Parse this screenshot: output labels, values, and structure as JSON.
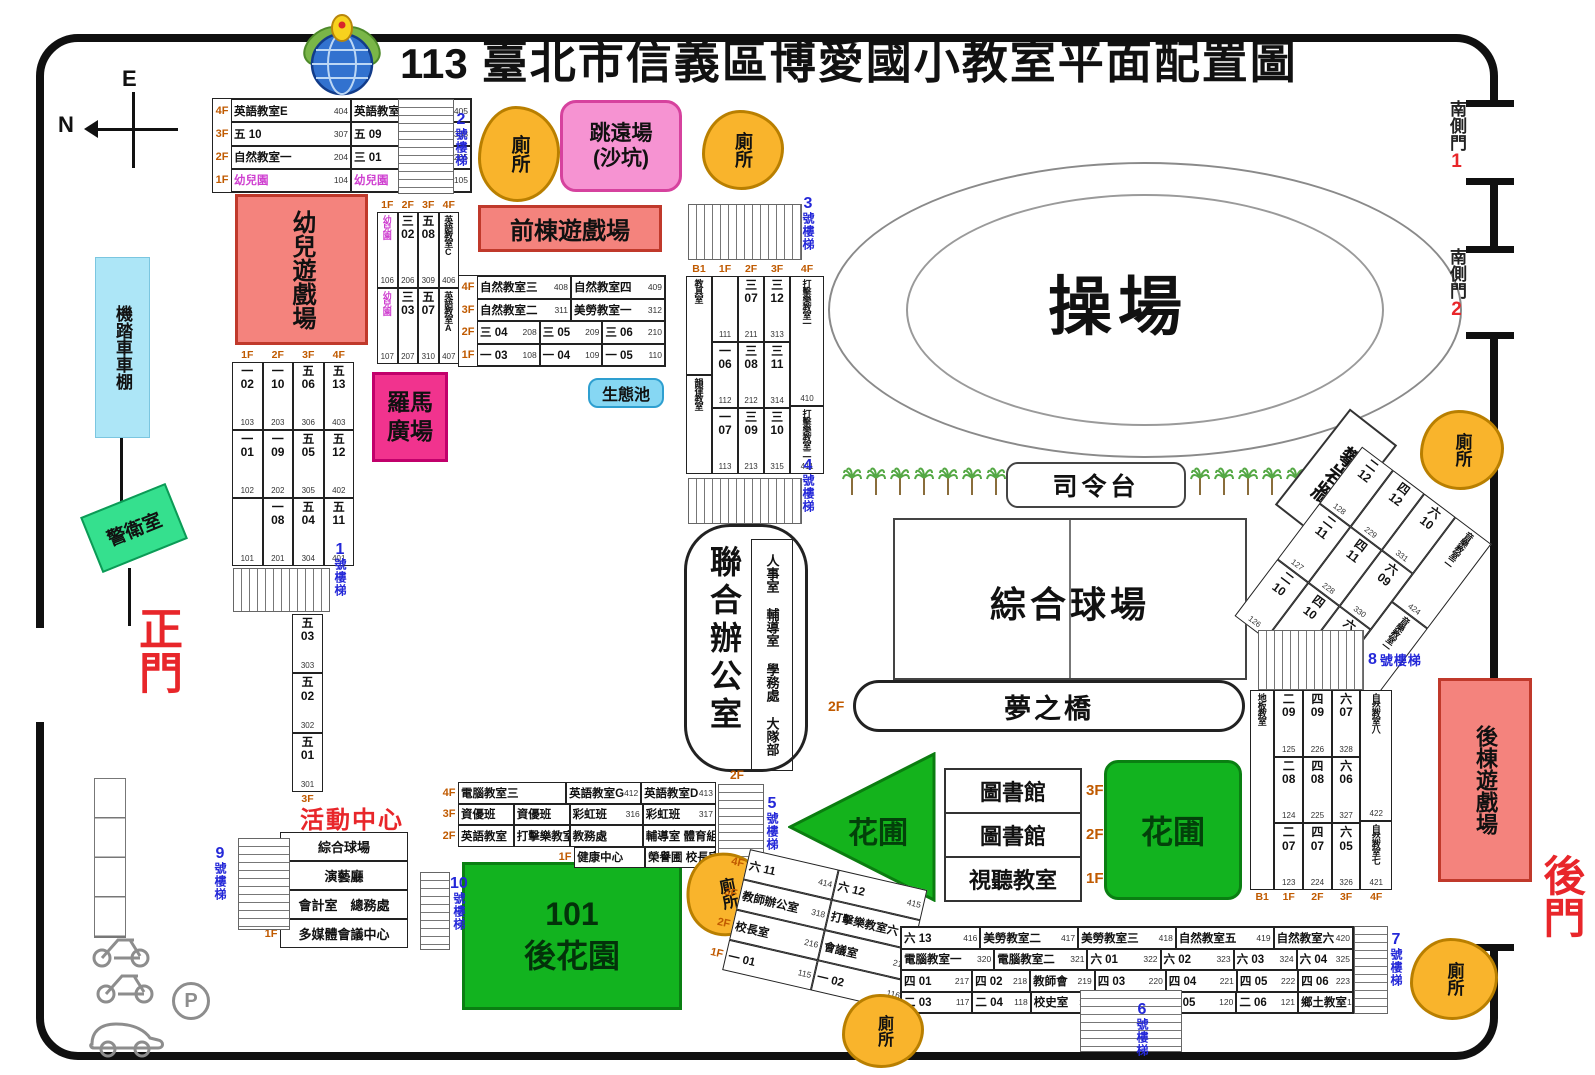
{
  "title": {
    "year": "113",
    "text": "臺北市信義區博愛國小教室平面配置圖"
  },
  "compass": {
    "e": "E",
    "n": "N"
  },
  "gates": {
    "main": "正門",
    "back": "後門",
    "south": "南側門",
    "south1_num": "1",
    "south2_num": "2"
  },
  "stairs": {
    "suffix": "號樓梯",
    "s1": {
      "n": "1",
      "t": "號樓梯"
    },
    "s2": {
      "n": "2",
      "t": "號樓梯"
    },
    "s3": {
      "n": "3",
      "t": "號樓梯"
    },
    "s4": {
      "n": "4",
      "t": "號樓梯"
    },
    "s5": {
      "n": "5",
      "t": "號樓梯"
    },
    "s6": {
      "n": "6",
      "t": "號樓梯"
    },
    "s7": {
      "n": "7",
      "t": "號樓梯"
    },
    "s8": {
      "n": "8",
      "t": "號樓梯"
    },
    "s9": {
      "n": "9",
      "t": "號樓梯"
    },
    "s10": {
      "n": "10",
      "t": "號樓梯"
    }
  },
  "zones": {
    "kinder_play": "幼兒遊戲場",
    "front_play": "前棟遊戲場",
    "back_play": "後棟遊戲場",
    "long_jump": [
      "跳遠場",
      "(沙坑)"
    ],
    "roman_plaza": [
      "羅馬",
      "廣場"
    ],
    "eco_pond": "生態池",
    "bike_shed": "機踏車車棚",
    "guard": "警衛室",
    "toilet": "廁所",
    "track": "操場",
    "stage": "司令台",
    "court": "綜合球場",
    "dream_bridge": "夢之橋",
    "dream_bridge_floor": "2F",
    "flower_tri": "花圃",
    "flower_sq": "花圃",
    "back_garden": [
      "101",
      "後花園"
    ],
    "climb_wall": "攀岩牆",
    "parking_p": "P",
    "strip_3f": "3F"
  },
  "joint_office": {
    "title": "聯合辦公室",
    "rooms": [
      "人事室",
      "輔導室",
      "學務處",
      "大隊部"
    ],
    "floor": "2F"
  },
  "library": {
    "rows": [
      {
        "t": "圖書館",
        "f": "3F"
      },
      {
        "t": "圖書館",
        "f": "2F"
      },
      {
        "t": "視聽教室",
        "f": "1F"
      }
    ]
  },
  "activity": {
    "title": "活動中心",
    "grid": {
      "rows": [
        {
          "cells": [
            {
              "fl": "4F"
            },
            {
              "t": "綜合球場"
            }
          ]
        },
        {
          "cells": [
            {
              "fl": "3F"
            },
            {
              "t": "演藝廳"
            }
          ]
        },
        {
          "cells": [
            {
              "fl": "2F"
            },
            {
              "t": "會計室　總務處"
            }
          ]
        },
        {
          "cells": [
            {
              "fl": "1F"
            },
            {
              "t": "多媒體會議中心"
            }
          ]
        }
      ]
    }
  },
  "tables": {
    "topleft": {
      "rows": [
        {
          "cells": [
            {
              "fl": "4F"
            },
            {
              "t": "英語教室E",
              "n": "404"
            },
            {
              "t": "英語教室F",
              "n": "405"
            }
          ]
        },
        {
          "cells": [
            {
              "fl": "3F"
            },
            {
              "t": "五 10",
              "n": "307"
            },
            {
              "t": "五 09",
              "n": "308"
            }
          ]
        },
        {
          "cells": [
            {
              "fl": "2F"
            },
            {
              "t": "自然教室一",
              "n": "204"
            },
            {
              "t": "三 01",
              "n": "205"
            }
          ]
        },
        {
          "cells": [
            {
              "fl": "1F"
            },
            {
              "t": "幼兒園",
              "n": "104",
              "pink": 1
            },
            {
              "t": "幼兒園",
              "n": "105",
              "pink": 1
            }
          ]
        }
      ]
    },
    "kinder": {
      "fpos": "top",
      "cols": [
        {
          "f": "1F",
          "cells": [
            {
              "t": "幼兒園",
              "n": "106",
              "v": 1,
              "pink": 1
            },
            {
              "t": "幼兒園",
              "n": "107",
              "v": 1,
              "pink": 1
            }
          ]
        },
        {
          "f": "2F",
          "cells": [
            {
              "g": "三",
              "r": "02",
              "n": "206"
            },
            {
              "g": "三",
              "r": "03",
              "n": "207"
            }
          ]
        },
        {
          "f": "3F",
          "cells": [
            {
              "g": "五",
              "r": "08",
              "n": "309"
            },
            {
              "g": "五",
              "r": "07",
              "n": "310"
            }
          ]
        },
        {
          "f": "4F",
          "cells": [
            {
              "t": "英語教室C",
              "n": "406",
              "v": 1
            },
            {
              "t": "英語教室A",
              "n": "407",
              "v": 1
            }
          ]
        }
      ]
    },
    "front": {
      "rows": [
        {
          "cells": [
            {
              "fl": "4F"
            },
            {
              "t": "自然教室三",
              "n": "408"
            },
            {
              "t": "自然教室四",
              "n": "409"
            }
          ]
        },
        {
          "cells": [
            {
              "fl": "3F"
            },
            {
              "t": "自然教室二",
              "n": "311"
            },
            {
              "t": "美勞教室一",
              "n": "312"
            }
          ]
        },
        {
          "cells": [
            {
              "fl": "2F"
            },
            {
              "t": "三 04",
              "n": "208"
            },
            {
              "t": "三 05",
              "n": "209"
            },
            {
              "t": "三 06",
              "n": "210"
            }
          ]
        },
        {
          "cells": [
            {
              "fl": "1F"
            },
            {
              "t": "一 03",
              "n": "108"
            },
            {
              "t": "一 04",
              "n": "109"
            },
            {
              "t": "一 05",
              "n": "110"
            }
          ]
        }
      ]
    },
    "leftgrid": {
      "fpos": "top",
      "cols": [
        {
          "f": "1F",
          "cells": [
            {
              "g": "一",
              "r": "02",
              "n": "103"
            },
            {
              "g": "一",
              "r": "01",
              "n": "102"
            },
            {
              "n": "101"
            }
          ]
        },
        {
          "f": "2F",
          "cells": [
            {
              "g": "一",
              "r": "10",
              "n": "203"
            },
            {
              "g": "一",
              "r": "09",
              "n": "202"
            },
            {
              "g": "一",
              "r": "08",
              "n": "201"
            }
          ]
        },
        {
          "f": "3F",
          "cells": [
            {
              "g": "五",
              "r": "06",
              "n": "306"
            },
            {
              "g": "五",
              "r": "05",
              "n": "305"
            },
            {
              "g": "五",
              "r": "04",
              "n": "304"
            }
          ]
        },
        {
          "f": "4F",
          "cells": [
            {
              "g": "五",
              "r": "13",
              "n": "403"
            },
            {
              "g": "五",
              "r": "12",
              "n": "402"
            },
            {
              "g": "五",
              "r": "11",
              "n": "401"
            }
          ]
        }
      ]
    },
    "five": {
      "fpos": "bottom",
      "cols": [
        {
          "f": "3F",
          "cells": [
            {
              "g": "五",
              "r": "03",
              "n": "303"
            },
            {
              "g": "五",
              "r": "02",
              "n": "302"
            },
            {
              "g": "五",
              "r": "01",
              "n": "301"
            }
          ]
        }
      ]
    },
    "mid": {
      "fpos": "top",
      "cols": [
        {
          "f": "B1",
          "cells": [
            {
              "t": "教具室",
              "v": 1
            },
            {
              "t": "韻律教室",
              "v": 1
            }
          ]
        },
        {
          "f": "1F",
          "cells": [
            {
              "n": "111"
            },
            {
              "g": "一",
              "r": "06",
              "n": "112"
            },
            {
              "g": "一",
              "r": "07",
              "n": "113"
            }
          ]
        },
        {
          "f": "2F",
          "cells": [
            {
              "g": "三",
              "r": "07",
              "n": "211"
            },
            {
              "g": "三",
              "r": "08",
              "n": "212"
            },
            {
              "g": "三",
              "r": "09",
              "n": "213"
            }
          ]
        },
        {
          "f": "3F",
          "cells": [
            {
              "g": "三",
              "r": "12",
              "n": "313"
            },
            {
              "g": "三",
              "r": "11",
              "n": "314"
            },
            {
              "g": "三",
              "r": "10",
              "n": "315"
            }
          ]
        },
        {
          "f": "4F",
          "w": 1.3,
          "cells": [
            {
              "t": "打擊樂教室一",
              "n": "410",
              "v": 1,
              "fx": 2
            },
            {
              "t": "打擊樂教室二",
              "n": "411",
              "v": 1
            }
          ]
        }
      ]
    },
    "bottomcenter": {
      "rows": [
        {
          "cells": [
            {
              "fl": "4F"
            },
            {
              "t": "電腦教室三",
              "w": 2
            },
            {
              "t": "英語教室G",
              "n": "412",
              "w": 1.35
            },
            {
              "t": "英語教室D",
              "n": "413",
              "w": 1.35
            }
          ]
        },
        {
          "cells": [
            {
              "fl": "3F"
            },
            {
              "t": "資優班"
            },
            {
              "t": "資優班"
            },
            {
              "t": "彩虹班",
              "n": "316",
              "w": 1.35
            },
            {
              "t": "彩虹班",
              "n": "317",
              "w": 1.35
            }
          ]
        },
        {
          "cells": [
            {
              "fl": "2F"
            },
            {
              "t": "英語教室"
            },
            {
              "t": "打擊樂教室五"
            },
            {
              "t": "教務處",
              "w": 1.35
            },
            {
              "t": "輔導室 體育組",
              "n": "215",
              "w": 1.35
            }
          ]
        },
        {
          "cells": [
            {
              "gap": 1,
              "w": 2.33
            },
            {
              "fl": "1F"
            },
            {
              "t": "健康中心",
              "n": "",
              "w": 1.35
            },
            {
              "t": "榮譽圃 校長室",
              "w": 1.35
            }
          ]
        }
      ]
    },
    "tilted_small": {
      "rows": [
        {
          "cells": [
            {
              "fl": "4F"
            },
            {
              "t": "六 11",
              "n": "414"
            },
            {
              "t": "六 12",
              "n": "415"
            }
          ]
        },
        {
          "cells": [
            {
              "fl": "3F"
            },
            {
              "t": "教師辦公室",
              "n": "318"
            },
            {
              "t": "打擊樂教室六",
              "n": "319"
            }
          ]
        },
        {
          "cells": [
            {
              "fl": "2F"
            },
            {
              "t": "校長室",
              "n": "216"
            },
            {
              "t": "會議室",
              "n": "218"
            }
          ]
        },
        {
          "cells": [
            {
              "fl": "1F"
            },
            {
              "t": "一 01",
              "n": "115"
            },
            {
              "t": "一 02",
              "n": "116"
            }
          ]
        }
      ]
    },
    "bottomright": {
      "rows": [
        {
          "cells": [
            {
              "t": "六 13",
              "n": "416"
            },
            {
              "t": "美勞教室二",
              "n": "417",
              "w": 1.25
            },
            {
              "t": "美勞教室三",
              "n": "418",
              "w": 1.25
            },
            {
              "t": "自然教室五",
              "n": "419",
              "w": 1.25
            },
            {
              "t": "自然教室六",
              "n": "420"
            }
          ]
        },
        {
          "cells": [
            {
              "t": "電腦教室一",
              "n": "320",
              "w": 1.3
            },
            {
              "t": "電腦教室二",
              "n": "321",
              "w": 1.3
            },
            {
              "t": "六 01",
              "n": "322"
            },
            {
              "t": "六 02",
              "n": "323"
            },
            {
              "t": "六 03",
              "n": "324",
              "w": 0.85
            },
            {
              "t": "六 04",
              "n": "325",
              "w": 0.75
            }
          ]
        },
        {
          "cells": [
            {
              "t": "四 01",
              "n": "217"
            },
            {
              "t": "四 02",
              "n": "218",
              "w": 0.8
            },
            {
              "t": "教師會",
              "n": "219",
              "w": 0.9
            },
            {
              "t": "四 03",
              "n": "220"
            },
            {
              "t": "四 04",
              "n": "221"
            },
            {
              "t": "四 05",
              "n": "222",
              "w": 0.85
            },
            {
              "t": "四 06",
              "n": "223",
              "w": 0.75
            }
          ]
        },
        {
          "cells": [
            {
              "t": "二 03",
              "n": "117"
            },
            {
              "t": "二 04",
              "n": "118",
              "w": 0.8
            },
            {
              "t": "校史室",
              "n": "119",
              "w": 0.9
            },
            {
              "gap": 1
            },
            {
              "t": "二 05",
              "n": "120"
            },
            {
              "t": "二 06",
              "n": "121",
              "w": 0.85
            },
            {
              "t": "鄉土教室",
              "n": "122",
              "w": 0.75
            }
          ]
        }
      ]
    },
    "stair8": {
      "fpos": "bottom",
      "cols": [
        {
          "f": "B1",
          "w": 0.85,
          "cells": [
            {
              "t": "地板教室",
              "v": 1
            }
          ]
        },
        {
          "f": "1F",
          "cells": [
            {
              "g": "二",
              "r": "09",
              "n": "125"
            },
            {
              "g": "二",
              "r": "08",
              "n": "124"
            },
            {
              "g": "二",
              "r": "07",
              "n": "123"
            }
          ]
        },
        {
          "f": "2F",
          "cells": [
            {
              "g": "四",
              "r": "09",
              "n": "226"
            },
            {
              "g": "四",
              "r": "08",
              "n": "225"
            },
            {
              "g": "四",
              "r": "07",
              "n": "224"
            }
          ]
        },
        {
          "f": "3F",
          "cells": [
            {
              "g": "六",
              "r": "07",
              "n": "328"
            },
            {
              "g": "六",
              "r": "06",
              "n": "327"
            },
            {
              "g": "六",
              "r": "05",
              "n": "326"
            }
          ]
        },
        {
          "f": "4F",
          "w": 1.1,
          "cells": [
            {
              "t": "自然教室八",
              "n": "422",
              "v": 1,
              "fx": 2
            },
            {
              "t": "自然教室七",
              "n": "421",
              "v": 1
            }
          ]
        }
      ]
    },
    "tilted_right": {
      "cols": [
        {
          "cells": [
            {
              "g": "二",
              "r": "12",
              "n": "128"
            },
            {
              "g": "二",
              "r": "11",
              "n": "127"
            },
            {
              "g": "二",
              "r": "10",
              "n": "126"
            }
          ]
        },
        {
          "cells": [
            {
              "g": "四",
              "r": "12",
              "n": "229"
            },
            {
              "g": "四",
              "r": "11",
              "n": "228"
            },
            {
              "g": "四",
              "r": "10",
              "n": "227"
            }
          ]
        },
        {
          "cells": [
            {
              "g": "六",
              "r": "10",
              "n": "331"
            },
            {
              "g": "六",
              "r": "09",
              "n": "330"
            },
            {
              "g": "六",
              "r": "08",
              "n": "329"
            }
          ]
        },
        {
          "w": 1.15,
          "cells": [
            {
              "t": "音樂教室二",
              "n": "424",
              "v": 1
            },
            {
              "t": "音樂教室一",
              "n": "423",
              "v": 1
            }
          ]
        }
      ]
    }
  }
}
